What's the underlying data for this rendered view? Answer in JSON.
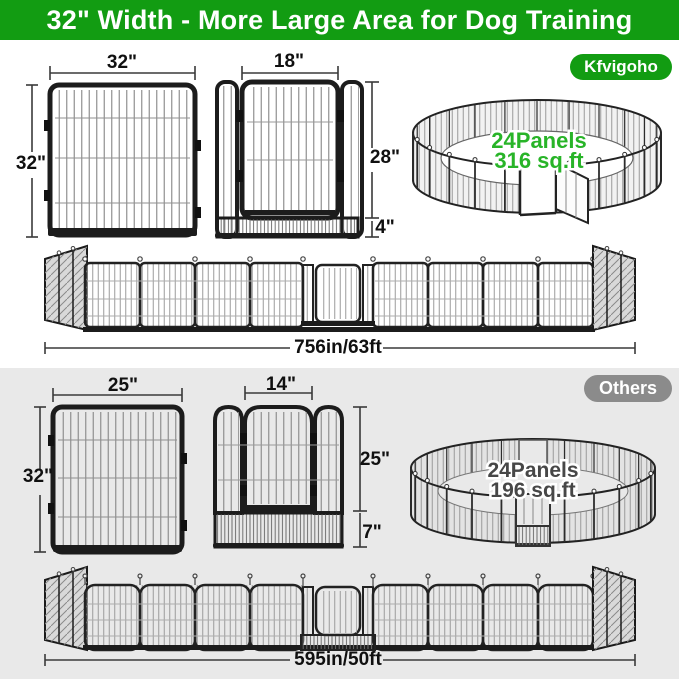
{
  "header": {
    "title": "32\" Width - More Large Area for Dog Training"
  },
  "colors": {
    "brand_green": "#129c12",
    "pen_text_green": "#28b428",
    "others_badge_gray": "#8b8b8b",
    "others_bg_gray": "#e9e9e9"
  },
  "brand_section": {
    "badge_label": "Kfvigoho",
    "panel": {
      "width_label": "32\"",
      "height_label": "32\""
    },
    "gate": {
      "width_label": "18\"",
      "door_height_label": "28\"",
      "bottom_height_label": "4\""
    },
    "pen": {
      "panels_label": "24Panels",
      "area_label": "316 sq.ft"
    },
    "row": {
      "length_label": "756in/63ft"
    }
  },
  "others_section": {
    "badge_label": "Others",
    "panel": {
      "width_label": "25\"",
      "height_label": "32\""
    },
    "gate": {
      "width_label": "14\"",
      "door_height_label": "25\"",
      "bottom_height_label": "7\""
    },
    "pen": {
      "panels_label": "24Panels",
      "area_label": "196 sq.ft"
    },
    "row": {
      "length_label": "595in/50ft"
    }
  }
}
